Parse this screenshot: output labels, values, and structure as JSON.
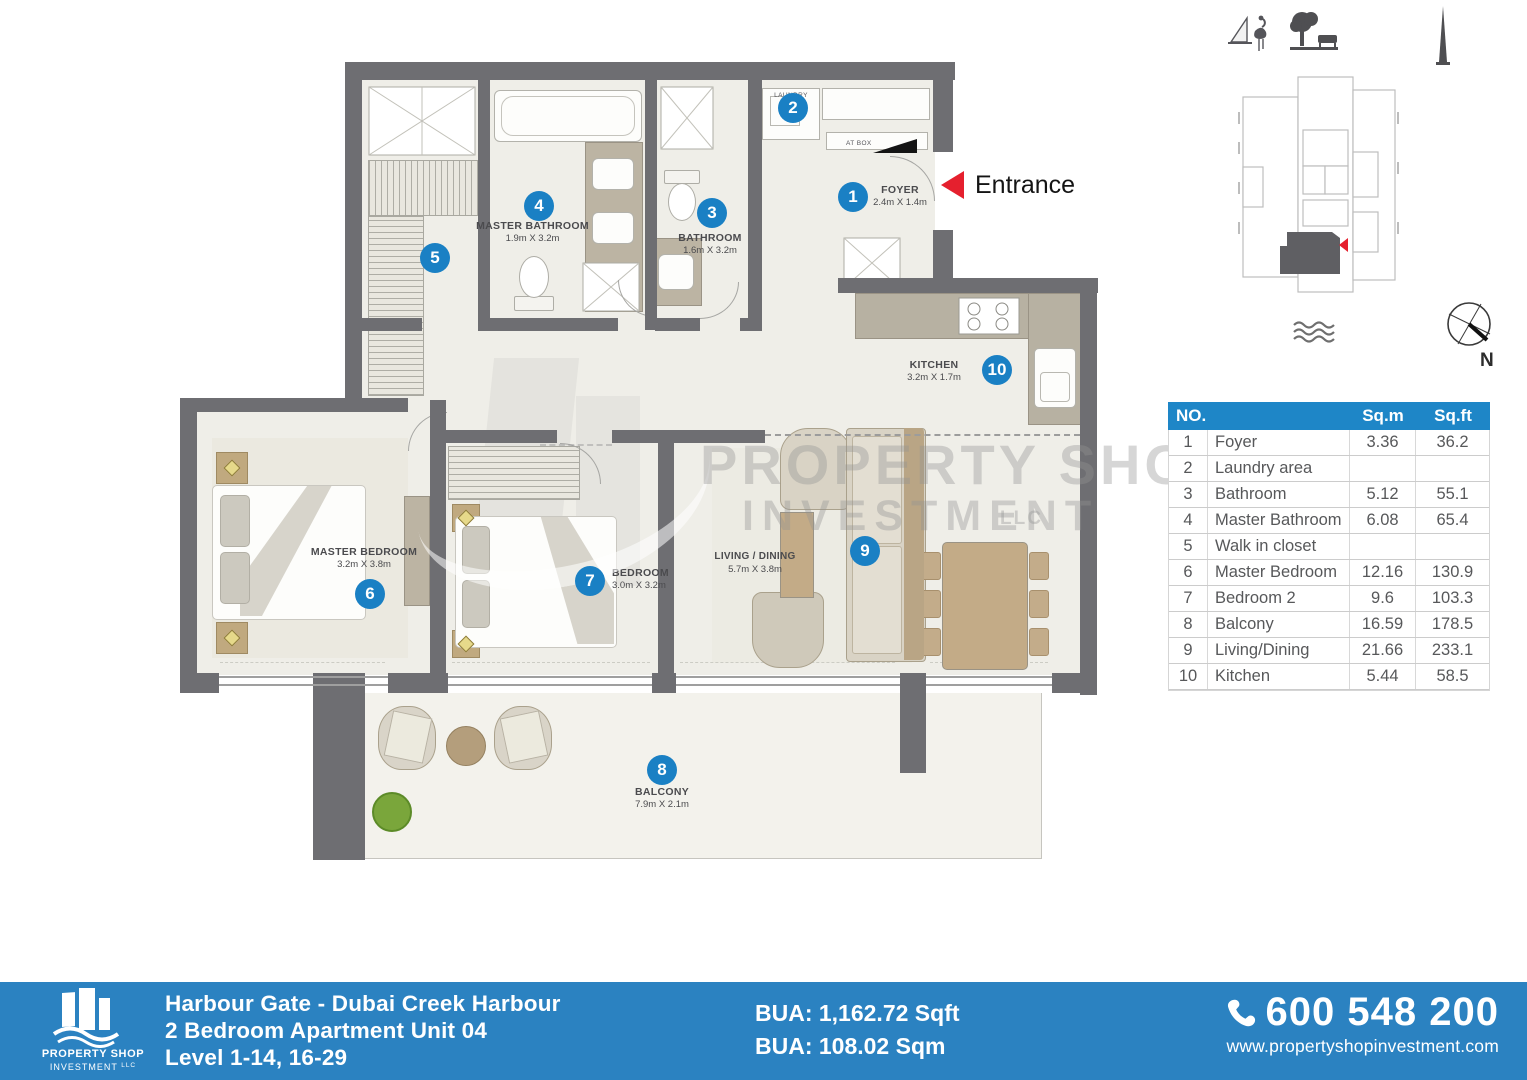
{
  "plan": {
    "entrance_label": "Entrance",
    "at_box": "AT BOX",
    "compass_n": "N",
    "watermark": {
      "l1": "PROPERTY SHOP",
      "l2": "INVESTMENT",
      "l3": "LLC"
    },
    "rooms": {
      "foyer": {
        "no": "1",
        "name": "FOYER",
        "dims": "2.4m X 1.4m"
      },
      "laundry": {
        "no": "2",
        "name": "LAUNDRY"
      },
      "bathroom": {
        "no": "3",
        "name": "BATHROOM",
        "dims": "1.6m X 3.2m"
      },
      "master_bathroom": {
        "no": "4",
        "name": "MASTER BATHROOM",
        "dims": "1.9m X 3.2m"
      },
      "walk_in_closet": {
        "no": "5"
      },
      "master_bedroom": {
        "no": "6",
        "name": "MASTER BEDROOM",
        "dims": "3.2m X 3.8m"
      },
      "bedroom2": {
        "no": "7",
        "name": "BEDROOM",
        "dims": "3.0m X 3.2m"
      },
      "balcony": {
        "no": "8",
        "name": "BALCONY",
        "dims": "7.9m X 2.1m"
      },
      "living": {
        "no": "9",
        "name": "LIVING / DINING",
        "dims": "5.7m X 3.8m"
      },
      "kitchen": {
        "no": "10",
        "name": "KITCHEN",
        "dims": "3.2m X 1.7m"
      }
    }
  },
  "area_table": {
    "headers": {
      "no": "NO.",
      "sqm": "Sq.m",
      "sqft": "Sq.ft"
    },
    "rows": [
      {
        "no": "1",
        "name": "Foyer",
        "sqm": "3.36",
        "sqft": "36.2"
      },
      {
        "no": "2",
        "name": "Laundry area",
        "sqm": "",
        "sqft": ""
      },
      {
        "no": "3",
        "name": "Bathroom",
        "sqm": "5.12",
        "sqft": "55.1"
      },
      {
        "no": "4",
        "name": "Master Bathroom",
        "sqm": "6.08",
        "sqft": "65.4"
      },
      {
        "no": "5",
        "name": "Walk in closet",
        "sqm": "",
        "sqft": ""
      },
      {
        "no": "6",
        "name": "Master Bedroom",
        "sqm": "12.16",
        "sqft": "130.9"
      },
      {
        "no": "7",
        "name": "Bedroom 2",
        "sqm": "9.6",
        "sqft": "103.3"
      },
      {
        "no": "8",
        "name": "Balcony",
        "sqm": "16.59",
        "sqft": "178.5"
      },
      {
        "no": "9",
        "name": "Living/Dining",
        "sqm": "21.66",
        "sqft": "233.1"
      },
      {
        "no": "10",
        "name": "Kitchen",
        "sqm": "5.44",
        "sqft": "58.5"
      }
    ]
  },
  "footer": {
    "logo": {
      "line1": "PROPERTY SHOP",
      "line2": "INVESTMENT",
      "suffix": "LLC"
    },
    "title1": "Harbour Gate - Dubai Creek Harbour",
    "title2": "2 Bedroom Apartment Unit 04",
    "title3": "Level  1-14, 16-29",
    "bua_sqft": "BUA: 1,162.72 Sqft",
    "bua_sqm": "BUA: 108.02 Sqm",
    "phone": "600 548 200",
    "website": "www.propertyshopinvestment.com"
  },
  "colors": {
    "accent_blue": "#1e86c7",
    "footer_blue": "#2b82c1",
    "entrance_red": "#e5202e",
    "wall_gray": "#6e6e72"
  }
}
